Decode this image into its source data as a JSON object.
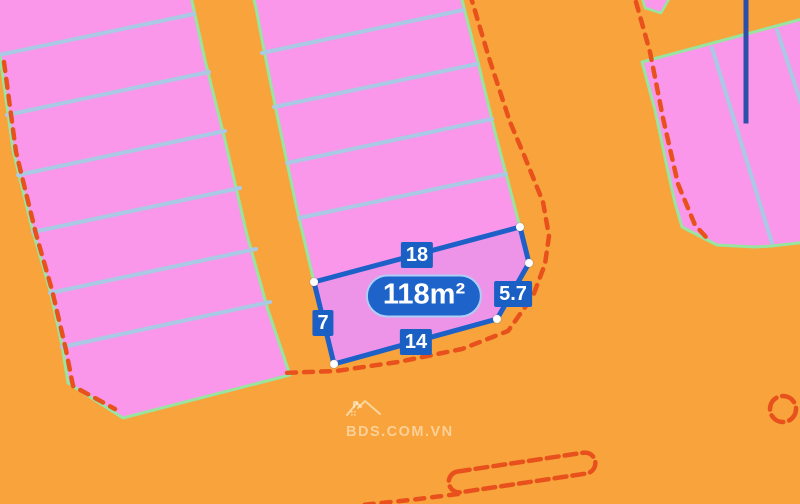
{
  "map": {
    "highlighted_plot": {
      "area_label": "118m²",
      "dimensions": {
        "top": "18",
        "right": "5.7",
        "bottom": "14",
        "left": "7"
      }
    },
    "watermark": {
      "text": "BDS.COM.VN",
      "icon": "house-icon"
    },
    "colors": {
      "road_orange": "#F8A33C",
      "plot_pink": "#FA97EA",
      "plot_border_green": "#98E5A0",
      "plot_divider_blue": "#A9C9E4",
      "highlight_blue": "#1C60C8",
      "label_bg_blue": "#1A5FC4",
      "label_text": "#FFFFFF",
      "road_edge_red": "#E8511C",
      "measure_line_blue": "#2C50AA",
      "vertex_dot": "#FFFFFF",
      "watermark_tint": "rgba(255,246,224,0.55)"
    }
  }
}
